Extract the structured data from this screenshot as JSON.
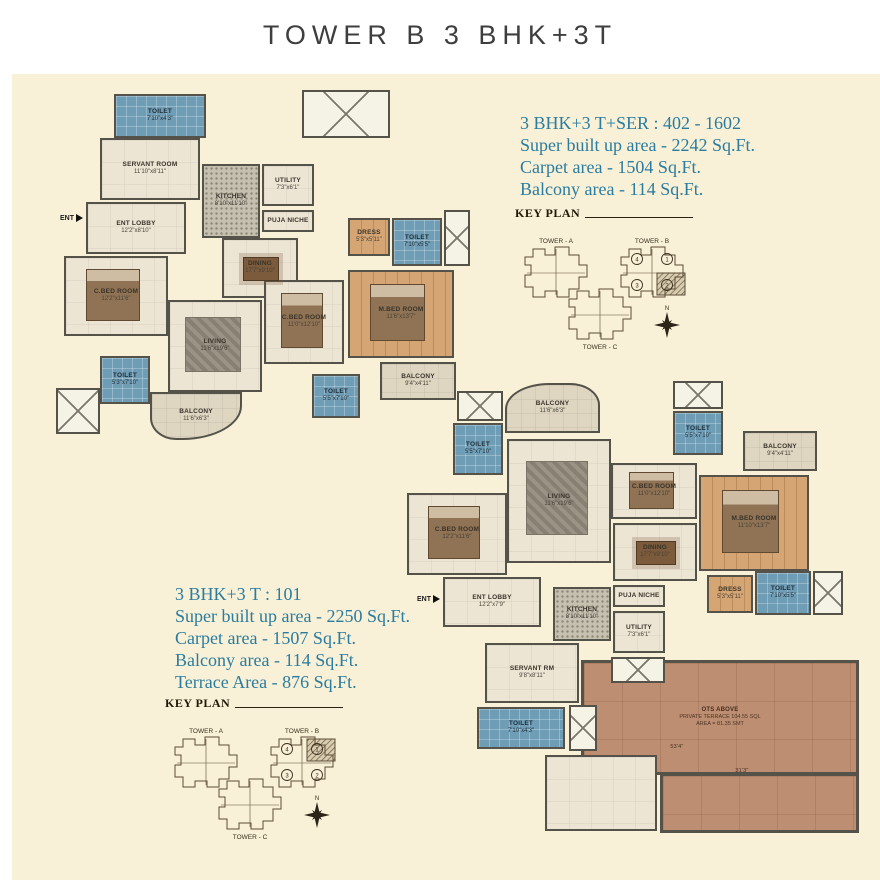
{
  "page": {
    "title": "TOWER B 3 BHK+3T"
  },
  "palette": {
    "cream": "#f8f0d7",
    "wall": "#55524a",
    "floor": "#ece5d4",
    "toilet": "#6f9db6",
    "wood": "#d5a673",
    "kitchen": "#c6c0b1",
    "balcony": "#ded6c1",
    "terrace": "#bd8e71",
    "teal": "#2b7c9e",
    "shaft": "#f5f2e6"
  },
  "unit_a": {
    "heading": "3 BHK+3 T+SER : 402 - 1602",
    "lines": [
      "Super built up area - 2242 Sq.Ft.",
      "Carpet area - 1504 Sq.Ft.",
      "Balcony area - 114 Sq.Ft."
    ]
  },
  "unit_b": {
    "heading": "3 BHK+3 T : 101",
    "lines": [
      "Super built up area - 2250 Sq.Ft.",
      "Carpet area - 1507 Sq.Ft.",
      "Balcony area - 114 Sq.Ft.",
      "Terrace Area - 876 Sq.Ft."
    ]
  },
  "key_plan": {
    "title": "KEY PLAN",
    "tower_a": "TOWER - A",
    "tower_b": "TOWER - B",
    "tower_c": "TOWER - C",
    "units": [
      "4",
      "1",
      "3",
      "2"
    ],
    "north": "N"
  },
  "plans": [
    {
      "x": 50,
      "y": 88,
      "w": 420,
      "h": 385,
      "ent": {
        "x": 10,
        "y": 126,
        "label": "ENT"
      },
      "rooms": [
        {
          "type": "toilet",
          "label": "TOILET",
          "dim": "7'10\"x4'3\"",
          "x": 64,
          "y": 6,
          "w": 92,
          "h": 44
        },
        {
          "type": "shaft",
          "x": 252,
          "y": 2,
          "w": 88,
          "h": 48
        },
        {
          "type": "floor",
          "label": "SERVANT ROOM",
          "dim": "11'10\"x8'11\"",
          "x": 50,
          "y": 50,
          "w": 100,
          "h": 62
        },
        {
          "type": "kitchen",
          "label": "KITCHEN",
          "dim": "8'10\"x11'10\"",
          "x": 152,
          "y": 76,
          "w": 58,
          "h": 74
        },
        {
          "type": "floor",
          "label": "UTILITY",
          "dim": "7'3\"x6'1\"",
          "x": 212,
          "y": 76,
          "w": 52,
          "h": 42
        },
        {
          "type": "floor",
          "label": "PUJA NICHE",
          "x": 212,
          "y": 122,
          "w": 52,
          "h": 22
        },
        {
          "type": "floor",
          "label": "ENT LOBBY",
          "dim": "12'2\"x8'10\"",
          "x": 36,
          "y": 114,
          "w": 100,
          "h": 52
        },
        {
          "type": "floor",
          "label": "C.BED ROOM",
          "dim": "12'2\"x11'6\"",
          "x": 14,
          "y": 168,
          "w": 104,
          "h": 80,
          "furn": "bed"
        },
        {
          "type": "floor",
          "label": "DINING",
          "dim": "17'7\"x9'10\"",
          "x": 172,
          "y": 150,
          "w": 76,
          "h": 60,
          "furn": "table"
        },
        {
          "type": "floor",
          "label": "LIVING",
          "dim": "11'6\"x19'6\"",
          "x": 118,
          "y": 212,
          "w": 94,
          "h": 92,
          "furn": "rug"
        },
        {
          "type": "wood",
          "label": "DRESS",
          "dim": "5'3\"x5'11\"",
          "x": 298,
          "y": 130,
          "w": 42,
          "h": 38
        },
        {
          "type": "toilet",
          "label": "TOILET",
          "dim": "7'10\"x5'5\"",
          "x": 342,
          "y": 130,
          "w": 50,
          "h": 48
        },
        {
          "type": "wood",
          "label": "M.BED ROOM",
          "dim": "11'6\"x13'7\"",
          "x": 298,
          "y": 182,
          "w": 106,
          "h": 88,
          "furn": "bed"
        },
        {
          "type": "floor",
          "label": "C.BED ROOM",
          "dim": "11'0\"x12'10\"",
          "x": 214,
          "y": 192,
          "w": 80,
          "h": 84,
          "furn": "bed"
        },
        {
          "type": "balcony",
          "label": "BALCONY",
          "dim": "9'4\"x4'11\"",
          "x": 330,
          "y": 274,
          "w": 76,
          "h": 38
        },
        {
          "type": "toilet",
          "label": "TOILET",
          "dim": "5'5\"x7'10\"",
          "x": 262,
          "y": 286,
          "w": 48,
          "h": 44
        },
        {
          "type": "toilet",
          "label": "TOILET",
          "dim": "5'3\"x7'10\"",
          "x": 50,
          "y": 268,
          "w": 50,
          "h": 48
        },
        {
          "type": "balcony",
          "label": "BALCONY",
          "dim": "11'6\"x6'3\"",
          "x": 100,
          "y": 304,
          "w": 92,
          "h": 48,
          "r": "0 0 60px 26px / 0 0 34px 22px"
        },
        {
          "type": "shaft",
          "x": 6,
          "y": 300,
          "w": 44,
          "h": 46
        },
        {
          "type": "shaft",
          "x": 394,
          "y": 122,
          "w": 26,
          "h": 56
        }
      ]
    },
    {
      "x": 405,
      "y": 375,
      "w": 460,
      "h": 462,
      "ent": {
        "x": 12,
        "y": 220,
        "label": "ENT"
      },
      "rooms": [
        {
          "type": "terrace",
          "label": "OTS ABOVE",
          "dim": "PRIVATE TERRACE 104.55 SQL",
          "dim2": "AREA = 81.35 SMT",
          "x": 176,
          "y": 285,
          "w": 278,
          "h": 115
        },
        {
          "type": "terrace",
          "x": 255,
          "y": 398,
          "w": 199,
          "h": 60
        },
        {
          "type": "balcony",
          "label": "BALCONY",
          "dim": "11'6\"x6'3\"",
          "x": 100,
          "y": 8,
          "w": 95,
          "h": 50,
          "r": "44px 30px 0 0 / 26px 22px 0 0"
        },
        {
          "type": "shaft",
          "x": 52,
          "y": 16,
          "w": 46,
          "h": 30
        },
        {
          "type": "toilet",
          "label": "TOILET",
          "dim": "5'5\"x7'10\"",
          "x": 48,
          "y": 48,
          "w": 50,
          "h": 52
        },
        {
          "type": "shaft",
          "x": 268,
          "y": 6,
          "w": 50,
          "h": 28
        },
        {
          "type": "toilet",
          "label": "TOILET",
          "dim": "5'5\"x7'10\"",
          "x": 268,
          "y": 36,
          "w": 50,
          "h": 44
        },
        {
          "type": "balcony",
          "label": "BALCONY",
          "dim": "9'4\"x4'11\"",
          "x": 338,
          "y": 56,
          "w": 74,
          "h": 40
        },
        {
          "type": "floor",
          "label": "C.BED ROOM",
          "dim": "12'2\"x11'6\"",
          "x": 2,
          "y": 118,
          "w": 100,
          "h": 82,
          "furn": "bed"
        },
        {
          "type": "floor",
          "label": "LIVING",
          "dim": "11'6\"x19'6\"",
          "x": 102,
          "y": 64,
          "w": 104,
          "h": 124,
          "furn": "rug"
        },
        {
          "type": "floor",
          "label": "C.BED ROOM",
          "dim": "11'0\"x12'10\"",
          "x": 206,
          "y": 88,
          "w": 86,
          "h": 56,
          "furn": "bed"
        },
        {
          "type": "wood",
          "label": "M.BED ROOM",
          "dim": "11'10\"x13'7\"",
          "x": 294,
          "y": 100,
          "w": 110,
          "h": 96,
          "furn": "bed"
        },
        {
          "type": "floor",
          "label": "DINING",
          "dim": "17'7\"x9'10\"",
          "x": 208,
          "y": 148,
          "w": 84,
          "h": 58,
          "furn": "table"
        },
        {
          "type": "wood",
          "label": "DRESS",
          "dim": "5'3\"x5'11\"",
          "x": 302,
          "y": 200,
          "w": 46,
          "h": 38
        },
        {
          "type": "toilet",
          "label": "TOILET",
          "dim": "7'10\"x5'5\"",
          "x": 350,
          "y": 196,
          "w": 56,
          "h": 44
        },
        {
          "type": "shaft",
          "x": 408,
          "y": 196,
          "w": 30,
          "h": 44
        },
        {
          "type": "floor",
          "label": "ENT LOBBY",
          "dim": "12'2\"x7'9\"",
          "x": 38,
          "y": 202,
          "w": 98,
          "h": 50
        },
        {
          "type": "kitchen",
          "label": "KITCHEN",
          "dim": "8'10\"x11'10\"",
          "x": 148,
          "y": 212,
          "w": 58,
          "h": 54
        },
        {
          "type": "floor",
          "label": "PUJA NICHE",
          "x": 208,
          "y": 210,
          "w": 52,
          "h": 22
        },
        {
          "type": "floor",
          "label": "UTILITY",
          "dim": "7'3\"x6'1\"",
          "x": 208,
          "y": 236,
          "w": 52,
          "h": 42
        },
        {
          "type": "floor",
          "label": "SERVANT RM",
          "dim": "9'8\"x8'11\"",
          "x": 80,
          "y": 268,
          "w": 94,
          "h": 60
        },
        {
          "type": "toilet",
          "label": "TOILET",
          "dim": "7'10\"x4'3\"",
          "x": 72,
          "y": 332,
          "w": 88,
          "h": 42
        },
        {
          "type": "floor",
          "x": 140,
          "y": 380,
          "w": 112,
          "h": 76
        },
        {
          "type": "shaft",
          "x": 206,
          "y": 282,
          "w": 54,
          "h": 26
        },
        {
          "type": "shaft",
          "x": 164,
          "y": 330,
          "w": 28,
          "h": 46
        },
        {
          "type": "note",
          "label": "53'4\"",
          "x": 250,
          "y": 366,
          "w": 44,
          "h": 12
        },
        {
          "type": "note",
          "label": "31'3\"",
          "x": 315,
          "y": 390,
          "w": 44,
          "h": 12
        }
      ]
    }
  ]
}
